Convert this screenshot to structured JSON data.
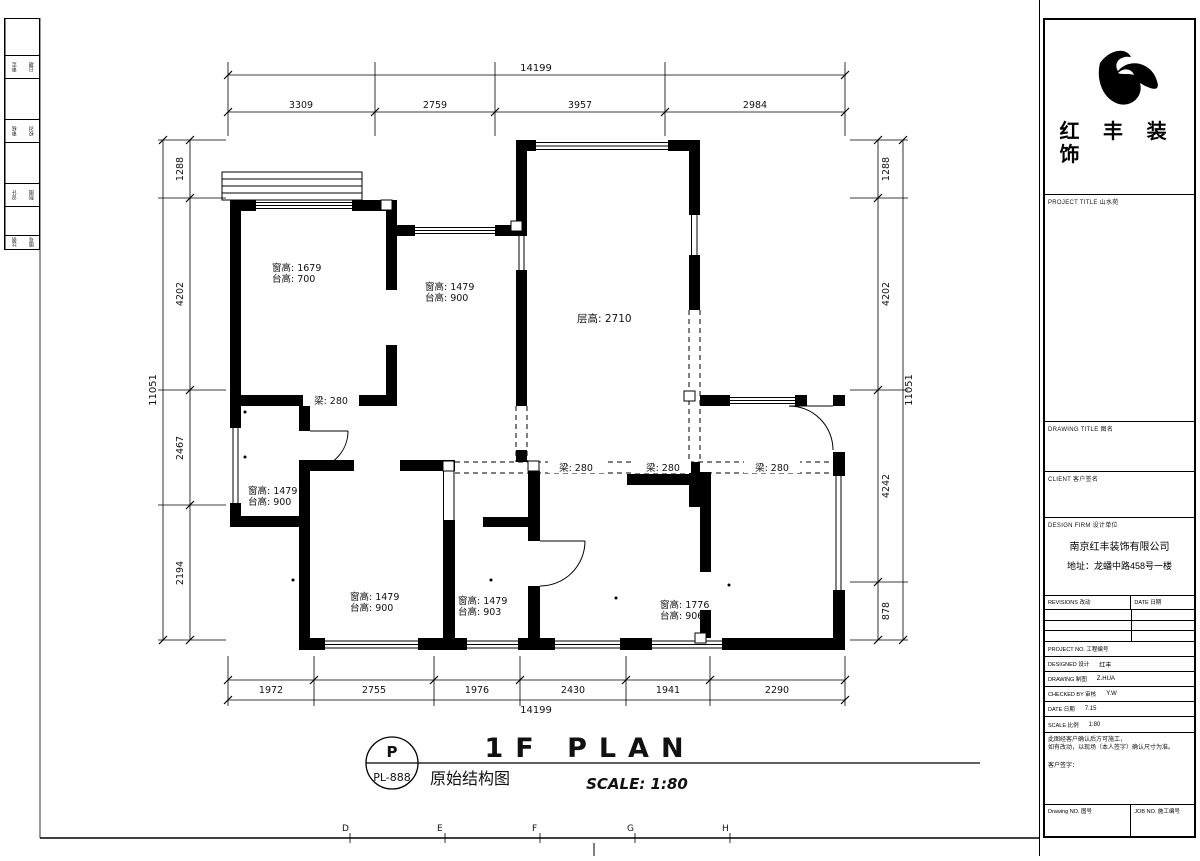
{
  "colors": {
    "line": "#000000",
    "paper": "#ffffff"
  },
  "sheet": {
    "grid_letters": [
      "D",
      "E",
      "F",
      "G",
      "H"
    ]
  },
  "title_bar": {
    "mark_top": "P",
    "mark_bottom": "PL-888",
    "drawing_name": "原始结构图",
    "plan_title": "1F PLAN",
    "scale_label": "SCALE: 1:80"
  },
  "plan": {
    "floor_height_label": "层高: 2710",
    "beam_labels": [
      "梁: 280",
      "梁: 280",
      "梁: 280",
      "梁: 280"
    ],
    "rooms": [
      {
        "line1": "窗高: 1679",
        "line2": "台高: 700"
      },
      {
        "line1": "窗高: 1479",
        "line2": "台高: 900"
      },
      {
        "line1": "窗高: 1479",
        "line2": "台高: 900"
      },
      {
        "line1": "窗高: 1479",
        "line2": "台高: 900"
      },
      {
        "line1": "窗高: 1479",
        "line2": "台高: 903"
      },
      {
        "line1": "窗高: 1776",
        "line2": "台高: 906"
      }
    ],
    "dimensions": {
      "top": {
        "overall": "14199",
        "segments": [
          "3309",
          "2759",
          "3957",
          "2984"
        ]
      },
      "bottom": {
        "overall": "14199",
        "segments": [
          "1972",
          "2755",
          "1976",
          "2430",
          "1941",
          "2290"
        ]
      },
      "left": {
        "overall": "11051",
        "segments": [
          "1288",
          "4202",
          "2467",
          "2194"
        ]
      },
      "right": {
        "overall": "11051",
        "segments": [
          "1288",
          "4202",
          "4242",
          "878"
        ]
      }
    }
  },
  "left_strip": {
    "rows": [
      [
        "审定",
        "日期"
      ],
      [
        "审核",
        "校对"
      ],
      [
        "设计",
        "制图"
      ],
      [
        "比例",
        "图号"
      ]
    ]
  },
  "title_block": {
    "logo_text_1": "红 丰 装",
    "logo_text_2": "饰",
    "project_title_label": "PROJECT TITLE  山水苑",
    "drawing_title_label": "DRAWING TITLE  图名",
    "client_label": "CLIENT  客户签名",
    "design_firm_label": "DESIGN FIRM  设计单位",
    "company_name": "南京红丰装饰有限公司",
    "company_address": "地址：龙蟠中路458号一楼",
    "revisions_label": "REVISIONS  改动",
    "revisions_date_label": "DATE  日期",
    "rows": [
      {
        "label": "PROJECT NO.  工程编号",
        "value": ""
      },
      {
        "label": "DESIGNED  设计",
        "value": "红丰"
      },
      {
        "label": "DRAWING  制图",
        "value": "Z.HUA"
      },
      {
        "label": "CHECKED BY  审核",
        "value": "Y.W"
      },
      {
        "label": "DATE  日期",
        "value": "7.15"
      },
      {
        "label": "SCALE  比例",
        "value": "1:80"
      }
    ],
    "notes": [
      "此图经客户确认后方可施工，",
      "如有改动，以现场（本人签字）确认尺寸为准。",
      "客户签字："
    ],
    "drawing_no_label": "Drawing NO.  图号",
    "job_no_label": "JOB NO.  施工编号"
  }
}
